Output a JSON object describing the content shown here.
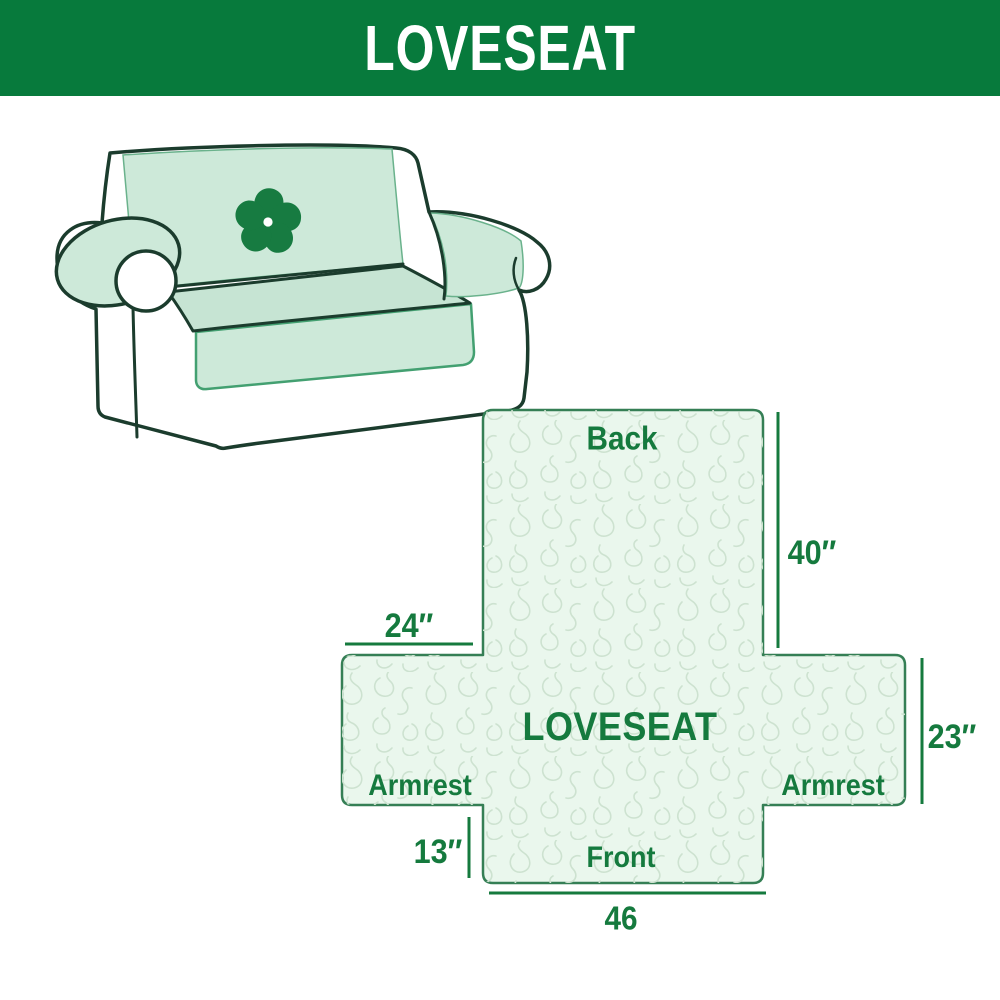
{
  "header": {
    "title": "LOVESEAT",
    "background_color": "#077a3c",
    "text_color": "#ffffff"
  },
  "illustration": {
    "description": "line-art loveseat sofa with light green protective slipcover",
    "logo_icon": "pinwheel-flower-icon",
    "cover_color": "#cde9d9",
    "seat_color": "#c6e4d3",
    "outline_color": "#1b3c2d",
    "logo_color": "#177b41"
  },
  "diagram": {
    "labels": {
      "back": "Back",
      "center": "LOVESEAT",
      "armrest_left": "Armrest",
      "armrest_right": "Armrest",
      "front": "Front"
    },
    "dimensions": {
      "back_height": "40″",
      "armrest_top_width": "24″",
      "armrest_side_height": "23″",
      "front_skirt_height": "13″",
      "front_width": "46"
    },
    "accent_color": "#157a3e",
    "fill_color": "#eaf7ed",
    "pattern_line_color": "#cde2d0",
    "outline_color": "#357f55"
  }
}
